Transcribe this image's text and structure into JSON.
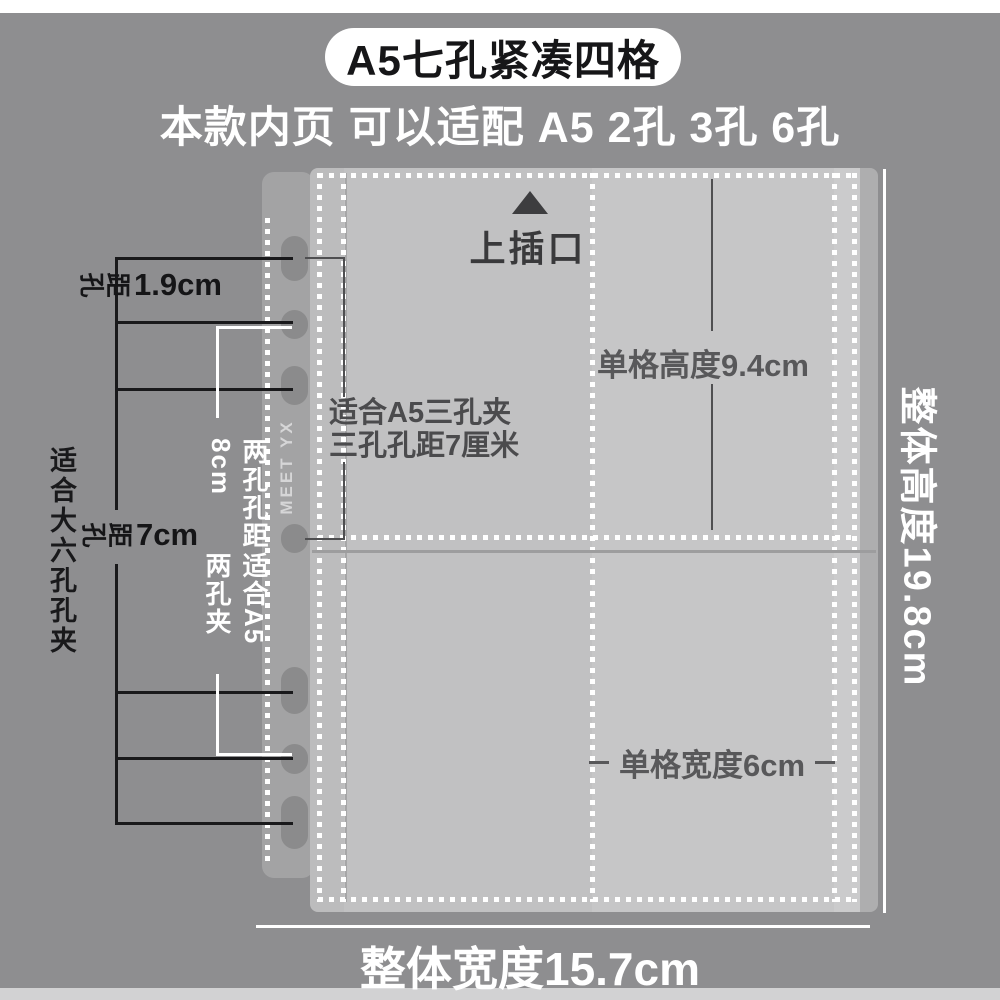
{
  "banner": {
    "title": "A5七孔紧凑四格"
  },
  "subtitle": "本款内页 可以适配 A5 2孔 3孔 6孔",
  "diagram": {
    "top_insert_label": "上插口",
    "top_insert_icon": "up-triangle-icon",
    "brand": "MEET YX",
    "cell_height_label": "单格高度9.4cm",
    "cell_width_label": "单格宽度6cm",
    "overall_width_label": "整体宽度15.7cm",
    "overall_height_label": "整体高度19.8cm",
    "three_hole_line1": "适合A5三孔夹",
    "three_hole_line2": "三孔孔距7厘米",
    "hole_gap_small": {
      "char1": "孔",
      "char2": "距",
      "value": "1.9cm"
    },
    "hole_gap_large": {
      "char1": "孔",
      "char2": "距",
      "value": "7cm"
    },
    "six_hole_label": "适合大六孔孔夹",
    "two_hole_col1": "两孔孔距8cm",
    "two_hole_col2": "适合A5两孔夹",
    "hole_count": 7
  },
  "colors": {
    "background": "#8e8e90",
    "page": "#c4c4c5",
    "spine": "#a3a3a4",
    "banner_bg": "#ffffff",
    "annotation_black": "#19191b",
    "annotation_white": "#ffffff",
    "label_gray": "#58585a"
  }
}
